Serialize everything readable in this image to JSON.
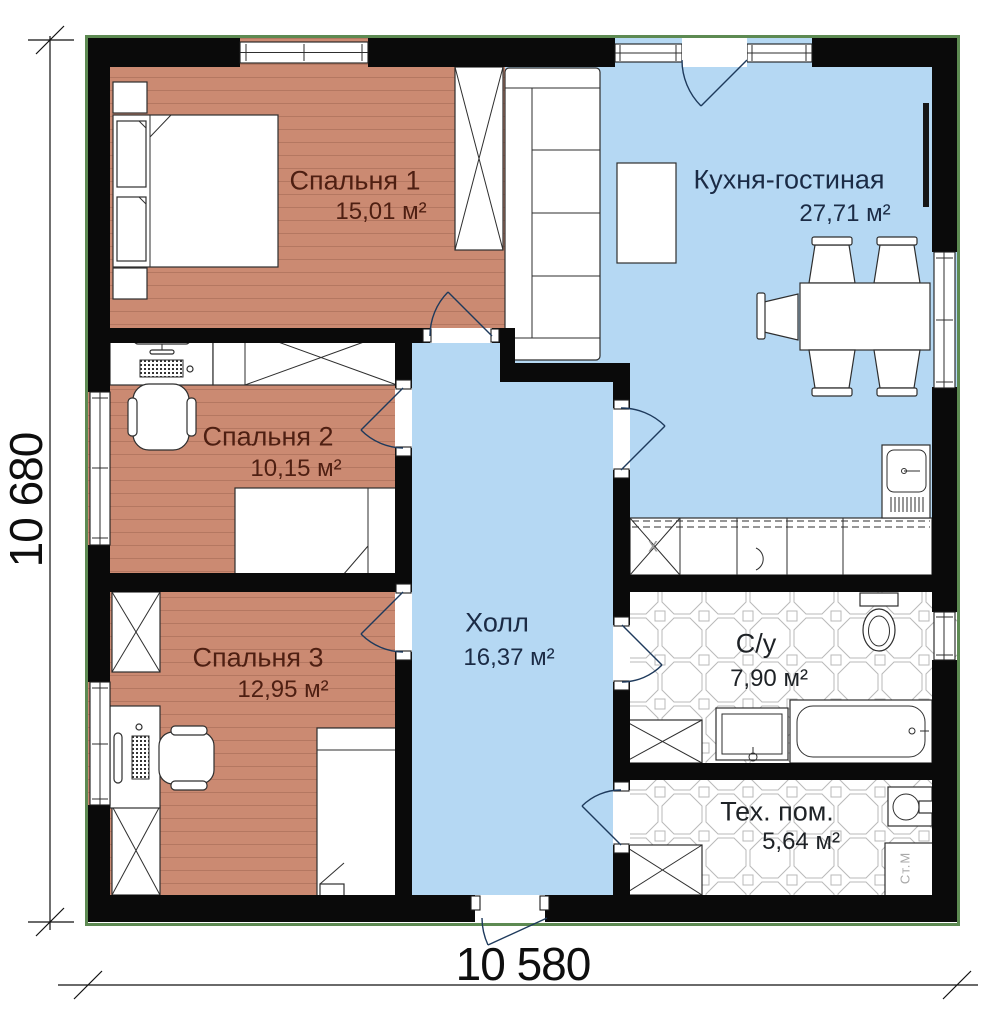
{
  "rooms": [
    {
      "id": "bedroom-1",
      "name": "Спальня 1",
      "area": "15,01 м²"
    },
    {
      "id": "kitchen-living",
      "name": "Кухня-гостиная",
      "area": "27,71 м²"
    },
    {
      "id": "bedroom-2",
      "name": "Спальня 2",
      "area": "10,15 м²"
    },
    {
      "id": "hall",
      "name": "Холл",
      "area": "16,37 м²"
    },
    {
      "id": "bedroom-3",
      "name": "Спальня 3",
      "area": "12,95 м²"
    },
    {
      "id": "bathroom",
      "name": "С/у",
      "area": "7,90 м²"
    },
    {
      "id": "utility-room",
      "name": "Тех. пом.",
      "area": "5,64 м²"
    }
  ],
  "dimensions": {
    "overall_width": "10 580",
    "overall_height": "10 680"
  },
  "annotations": {
    "washing_machine_label": "Ст.М",
    "hob_mark": "х"
  },
  "colors": {
    "wood_floor": "#cb8a72",
    "blue_floor": "#b5d8f3",
    "wall": "#0a0a0a",
    "bedroom_label": "#4e1f12",
    "living_label": "#1b2b45",
    "tile_label": "#1e2226",
    "door_swing": "#1e3a5c",
    "outline_green": "#5d8a52",
    "dim_text": "#0e0e0e"
  }
}
